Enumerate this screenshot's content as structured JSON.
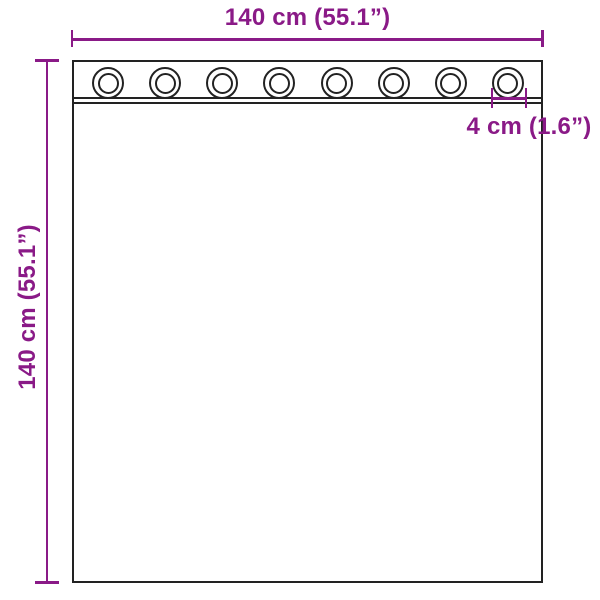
{
  "diagram": {
    "subject": "curtain-with-grommets-dimension-diagram"
  },
  "labels": {
    "width": "140 cm (55.1”)",
    "height": "140 cm (55.1”)",
    "grommet_spacing": "4 cm (1.6”)"
  },
  "grommets": {
    "count": 8
  },
  "colors": {
    "dimension": "#8A1A87",
    "outline": "#222222",
    "background": "#FFFFFF"
  }
}
